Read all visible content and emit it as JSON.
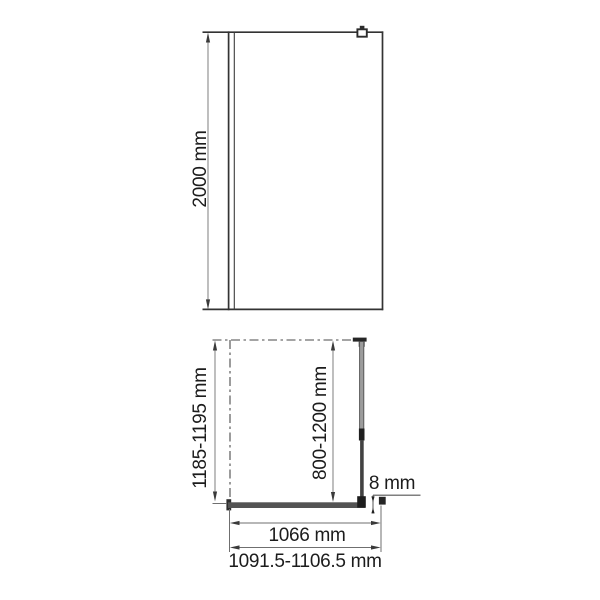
{
  "front_view": {
    "height_label": "2000 mm"
  },
  "plan_view": {
    "depth_label": "1185-1195 mm",
    "support_bar_label": "800-1200 mm",
    "glass_thickness_label": "8 mm",
    "glass_width_label": "1066 mm",
    "overall_width_label": "1091.5-1106.5 mm"
  },
  "colors": {
    "outline": "#333333",
    "dimension_line": "#6f6f6f",
    "arrow": "#3a3a3a",
    "text": "#1c1c1c",
    "glass_fill": "#535353",
    "tube_fill": "#9c9c9c"
  }
}
